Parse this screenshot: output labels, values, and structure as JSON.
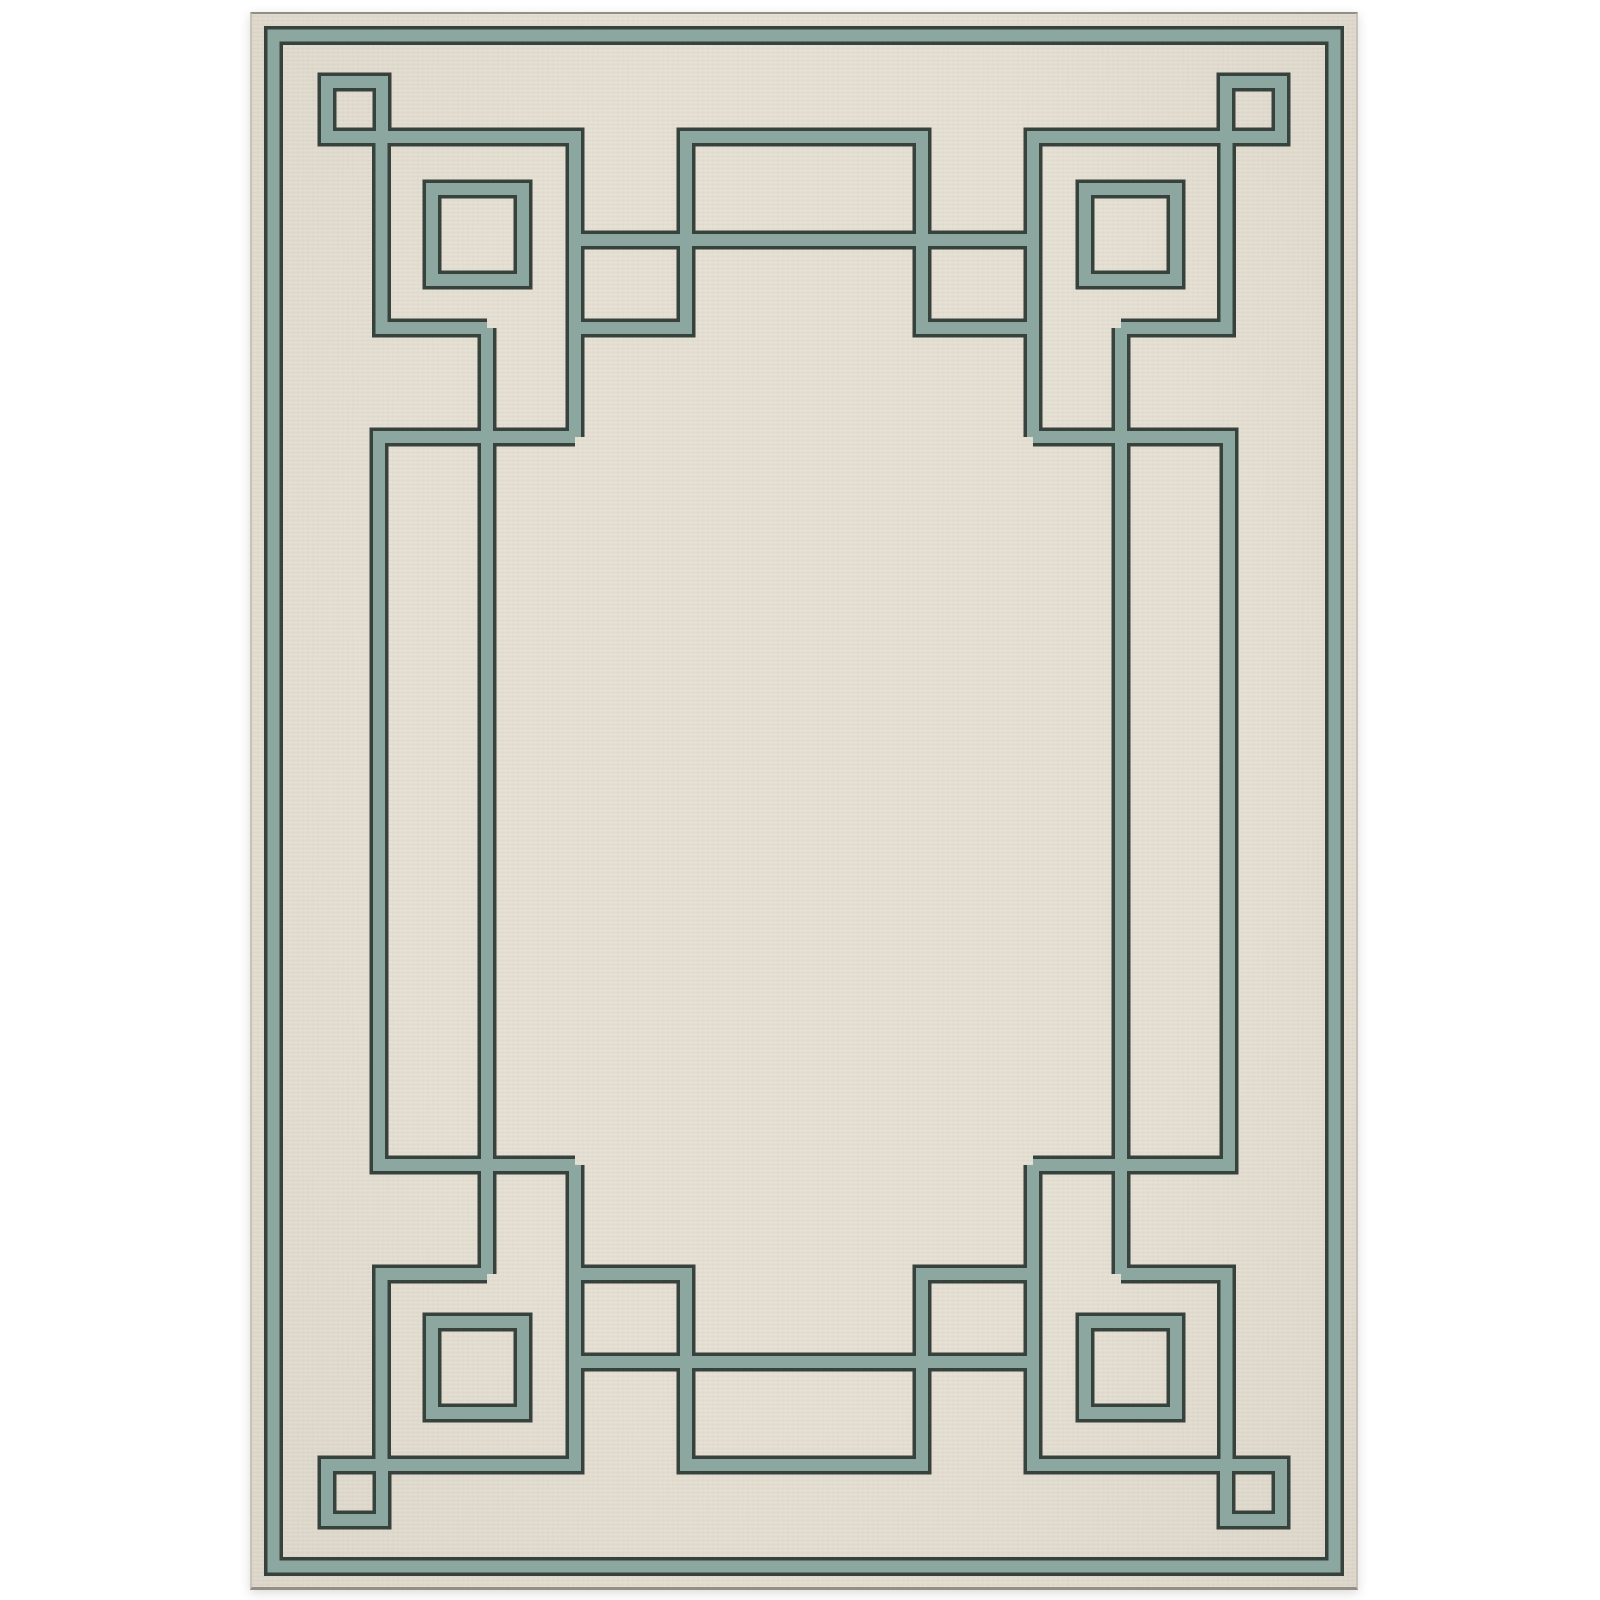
{
  "image": {
    "type": "product-photo",
    "subject": "rectangular area rug, portrait orientation, centered on a white background",
    "design": "ivory field with sage-teal Art Deco Greek-key fretwork border: a plain perimeter stripe, four corner motifs (small knot square plus large open square), tall open rectangles on the left and right sides, wide open rectangles at top and bottom center, and an inner connecting frame of interlocking lines",
    "texture": "flat-woven horizontal weave striations across the ivory pile"
  },
  "colors": {
    "page_bg": "#ffffff",
    "rug_field": "#e6e0d3",
    "band_teal": "#8ca7a0",
    "band_outline": "#37423d",
    "rug_edge": "#c8c3b6",
    "rug_edge_dark": "#938f84"
  },
  "pattern": {
    "rug_box": {
      "x": 250,
      "y": 12,
      "w": 1108,
      "h": 1578
    },
    "stroke_outer": 19,
    "stroke_inner": 12,
    "rings": [
      {
        "name": "outer-border-stripe",
        "x": 273.5,
        "y": 35.5,
        "w": 1061,
        "h": 1531
      },
      {
        "name": "corner-knot-square-tl",
        "x": 327,
        "y": 82,
        "w": 55,
        "h": 55
      },
      {
        "name": "corner-knot-square-tr",
        "x": 1226,
        "y": 82,
        "w": 55,
        "h": 55
      },
      {
        "name": "corner-knot-square-bl",
        "x": 327,
        "y": 1465,
        "w": 55,
        "h": 55
      },
      {
        "name": "corner-knot-square-br",
        "x": 1226,
        "y": 1465,
        "w": 55,
        "h": 55
      },
      {
        "name": "corner-big-square-tl",
        "x": 432,
        "y": 189,
        "w": 91,
        "h": 91
      },
      {
        "name": "corner-big-square-tr",
        "x": 1085,
        "y": 189,
        "w": 91,
        "h": 91
      },
      {
        "name": "corner-big-square-bl",
        "x": 432,
        "y": 1322,
        "w": 91,
        "h": 91
      },
      {
        "name": "corner-big-square-br",
        "x": 1085,
        "y": 1322,
        "w": 91,
        "h": 91
      },
      {
        "name": "side-ring-left",
        "x": 379,
        "y": 437,
        "w": 108,
        "h": 728
      },
      {
        "name": "side-ring-right",
        "x": 1121,
        "y": 437,
        "w": 108,
        "h": 728
      },
      {
        "name": "hanging-rect-tl",
        "x": 575,
        "y": 240,
        "w": 111,
        "h": 88
      },
      {
        "name": "hanging-rect-tr",
        "x": 922,
        "y": 240,
        "w": 111,
        "h": 88
      },
      {
        "name": "hanging-rect-bl",
        "x": 575,
        "y": 1274,
        "w": 111,
        "h": 88
      },
      {
        "name": "hanging-rect-br",
        "x": 922,
        "y": 1274,
        "w": 111,
        "h": 88
      },
      {
        "name": "center-rect-top",
        "x": 686,
        "y": 137,
        "w": 236,
        "h": 103
      },
      {
        "name": "center-rect-bottom",
        "x": 686,
        "y": 1362,
        "w": 236,
        "h": 103
      }
    ],
    "segments": [
      {
        "name": "knot-arm-tl",
        "d": "M 381.5 137 L 575 137 L 575 437"
      },
      {
        "name": "knot-drop-tl",
        "d": "M 381.5 137 L 381.5 328 L 487 328"
      },
      {
        "name": "knot-arm-tr",
        "d": "M 1226.5 137 L 1033 137 L 1033 437"
      },
      {
        "name": "knot-drop-tr",
        "d": "M 1226.5 137 L 1226.5 328 L 1121 328"
      },
      {
        "name": "knot-arm-bl",
        "d": "M 381.5 1465 L 575 1465 L 575 1165"
      },
      {
        "name": "knot-drop-bl",
        "d": "M 381.5 1465 L 381.5 1274 L 487 1274"
      },
      {
        "name": "knot-arm-br",
        "d": "M 1226.5 1465 L 1033 1465 L 1033 1165"
      },
      {
        "name": "knot-drop-br",
        "d": "M 1226.5 1465 L 1226.5 1274 L 1121 1274"
      },
      {
        "name": "frame-line-left",
        "d": "M 487 328 L 487 1274"
      },
      {
        "name": "frame-line-right",
        "d": "M 1121 328 L 1121 1274"
      },
      {
        "name": "frame-line-top",
        "d": "M 575 240 L 1033 240"
      },
      {
        "name": "frame-line-bottom",
        "d": "M 575 1362 L 1033 1362"
      },
      {
        "name": "connector-tl",
        "d": "M 379 437 L 575 437"
      },
      {
        "name": "connector-tr",
        "d": "M 1033 437 L 1229 437"
      },
      {
        "name": "connector-bl",
        "d": "M 379 1165 L 575 1165"
      },
      {
        "name": "connector-br",
        "d": "M 1033 1165 L 1229 1165"
      }
    ]
  }
}
